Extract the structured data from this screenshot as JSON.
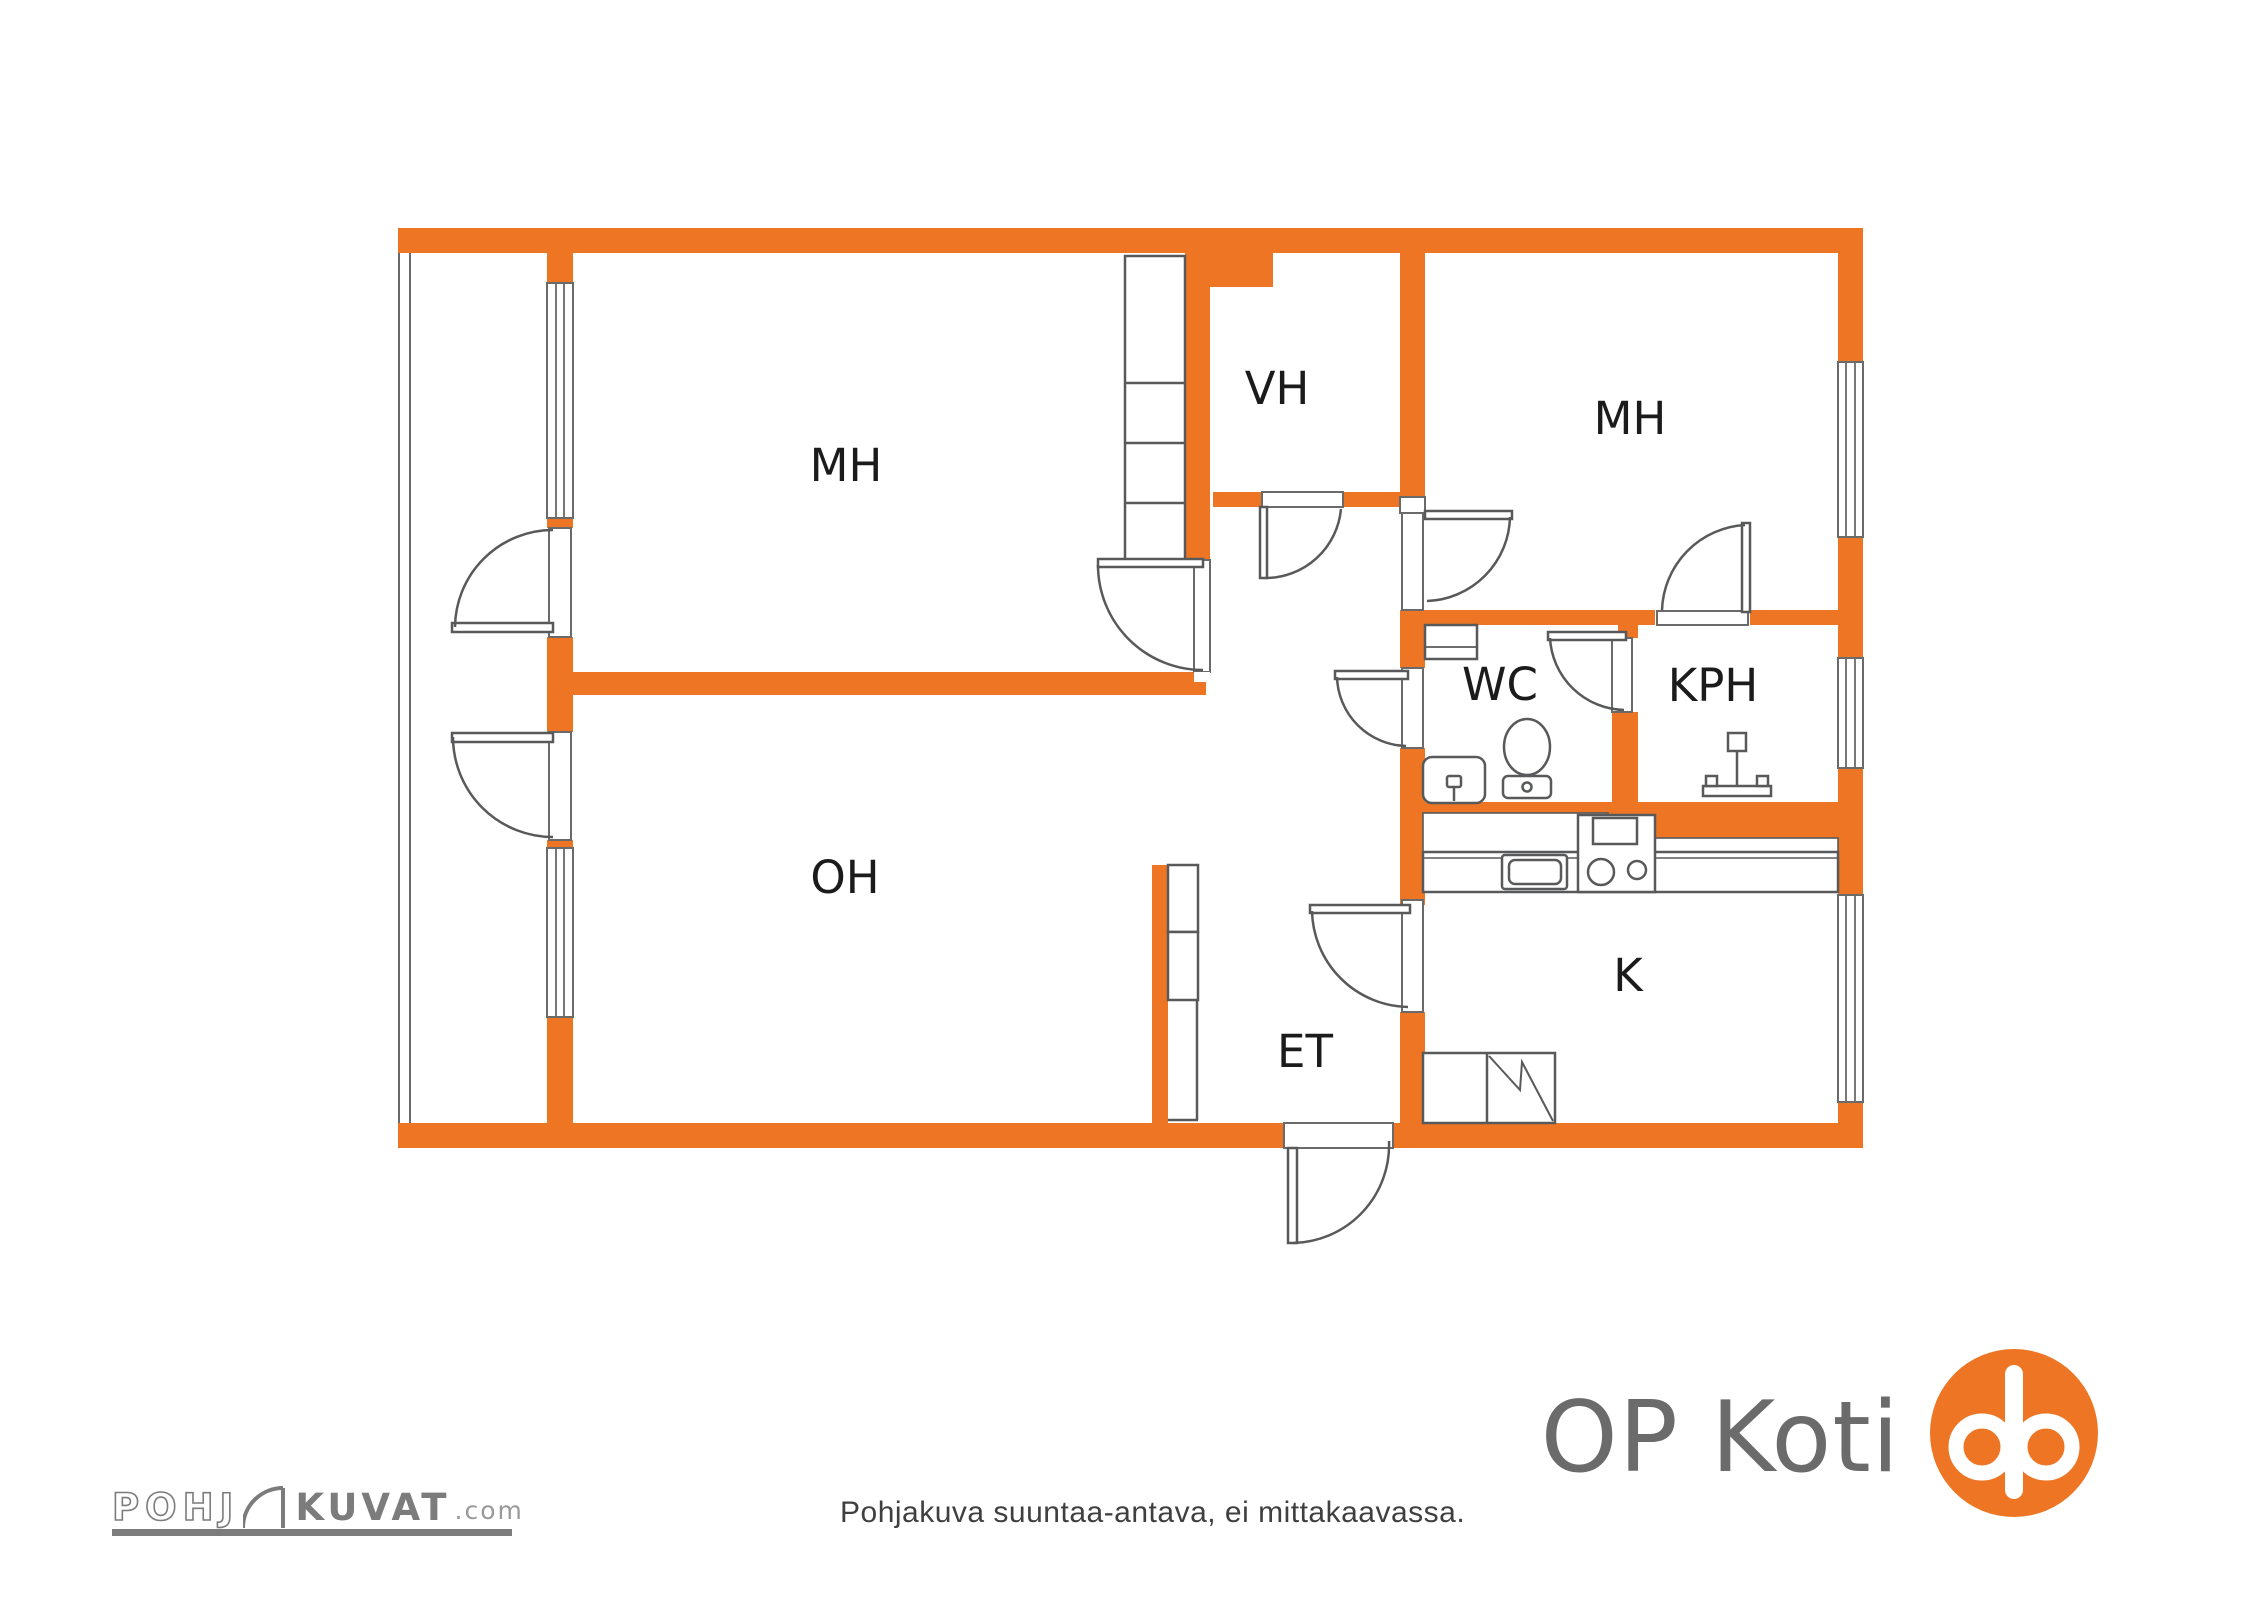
{
  "colors": {
    "wall": "#EE7523",
    "line": "#58595b",
    "open": "#6a6a6a",
    "label": "#1b1b1b",
    "op_gray": "#6b6b6b",
    "pk_gray": "#7c7c7c",
    "note": "#3f3f3f"
  },
  "plan": {
    "rooms": [
      {
        "id": "mh-left",
        "label": "MH"
      },
      {
        "id": "vh",
        "label": "VH"
      },
      {
        "id": "mh-right",
        "label": "MH"
      },
      {
        "id": "wc",
        "label": "WC"
      },
      {
        "id": "kph",
        "label": "KPH"
      },
      {
        "id": "oh",
        "label": "OH"
      },
      {
        "id": "et",
        "label": "ET"
      },
      {
        "id": "k",
        "label": "K"
      }
    ],
    "footnote": "Pohjakuva suuntaa-antava, ei mittakaavassa."
  },
  "branding": {
    "op_koti_text": "OP Koti",
    "pohjakuvat": {
      "prefix": "POHJ",
      "main": "KUVAT",
      "suffix": ".com"
    }
  }
}
